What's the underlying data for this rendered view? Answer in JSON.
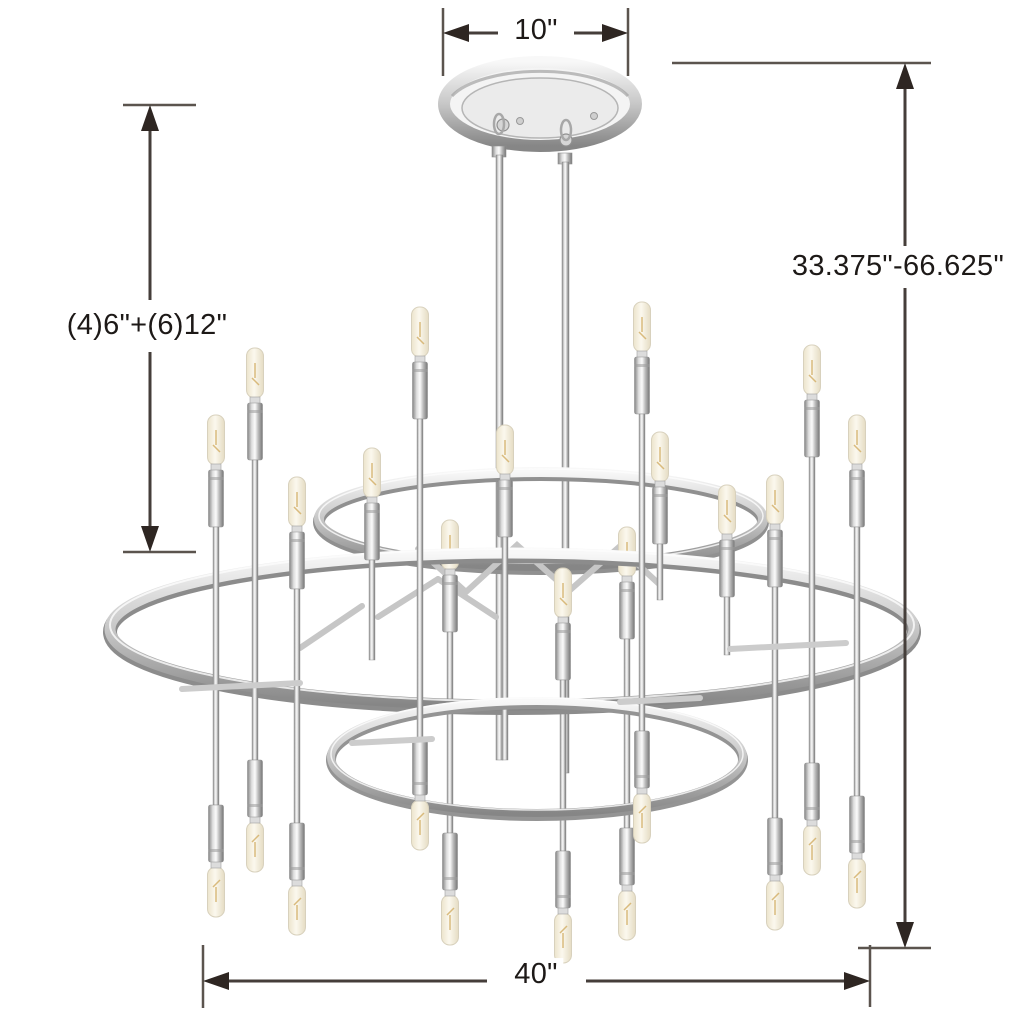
{
  "diagram": {
    "title": "Chandelier dimension diagram",
    "background_color": "#ffffff",
    "dimension_style": {
      "line_color": "#453e3a",
      "extension_line_color": "#5b544e",
      "arrow_color": "#2e2622",
      "text_color": "#1d1917"
    },
    "fixture": {
      "type": "two-tier open ring candelabra chandelier",
      "finish": "polished nickel",
      "metal_light": "#fafafa",
      "metal_mid": "#c9c9c9",
      "metal_dark": "#808080",
      "bulb_color": "#f7f2e2"
    },
    "dimensions": {
      "canopy_width": {
        "label": "10\"",
        "position": "top"
      },
      "hanging_height_range": {
        "label": "33.375\"-66.625\"",
        "position": "right"
      },
      "included_downrods": {
        "label": "(4)6\"+(6)12\"",
        "position": "left"
      },
      "fixture_width": {
        "label": "40\"",
        "position": "bottom"
      }
    }
  }
}
